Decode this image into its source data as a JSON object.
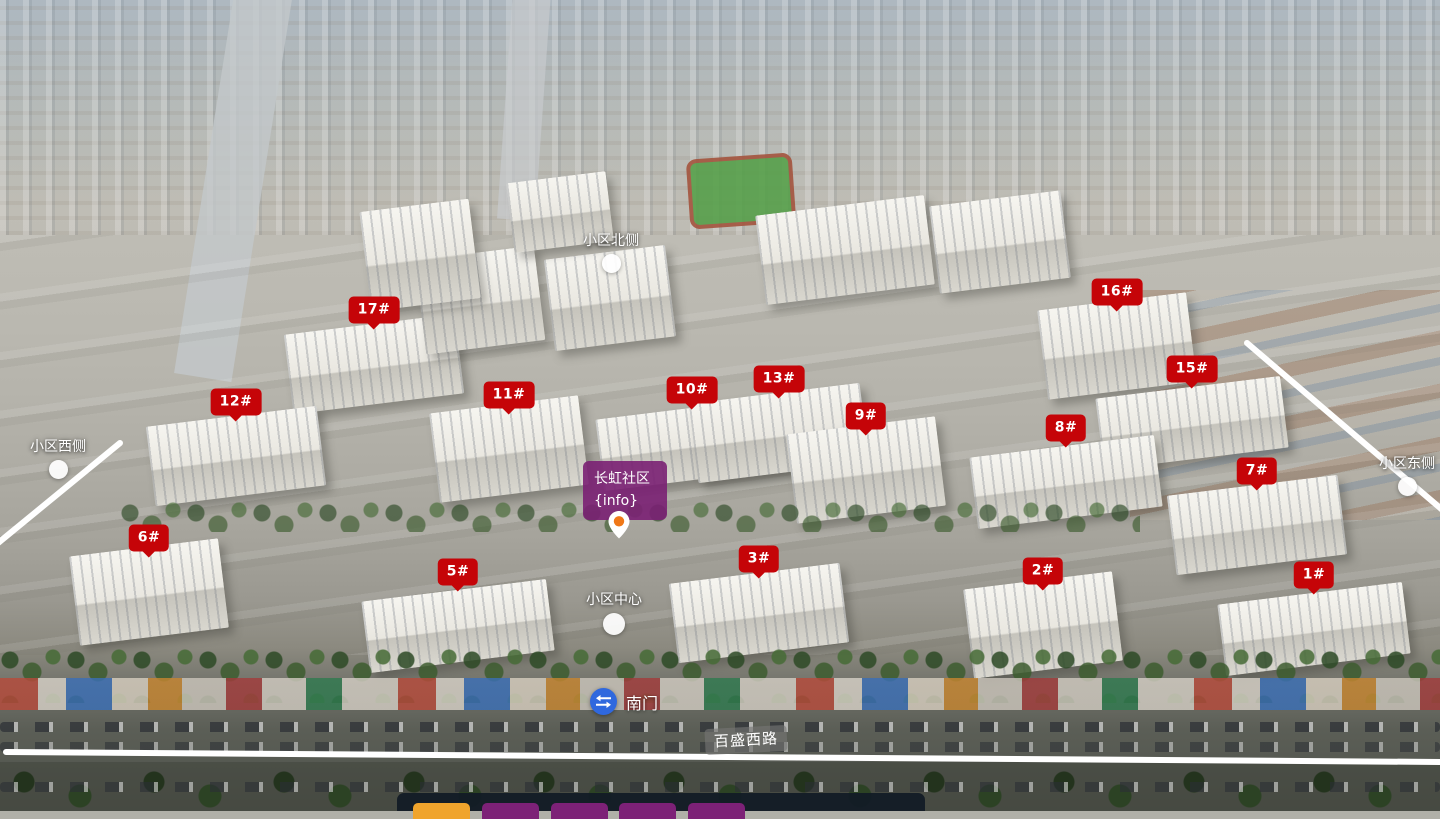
{
  "community": {
    "name_label": {
      "title": "长虹社区",
      "subtitle": "{info}",
      "x": 583,
      "y": 461
    }
  },
  "building_markers": [
    {
      "label": "17#",
      "x": 374,
      "y": 310
    },
    {
      "label": "16#",
      "x": 1117,
      "y": 292
    },
    {
      "label": "15#",
      "x": 1192,
      "y": 369
    },
    {
      "label": "12#",
      "x": 236,
      "y": 402
    },
    {
      "label": "11#",
      "x": 509,
      "y": 395
    },
    {
      "label": "10#",
      "x": 692,
      "y": 390
    },
    {
      "label": "13#",
      "x": 779,
      "y": 379
    },
    {
      "label": "9#",
      "x": 866,
      "y": 416
    },
    {
      "label": "8#",
      "x": 1066,
      "y": 428
    },
    {
      "label": "7#",
      "x": 1257,
      "y": 471
    },
    {
      "label": "6#",
      "x": 149,
      "y": 538
    },
    {
      "label": "5#",
      "x": 458,
      "y": 572
    },
    {
      "label": "3#",
      "x": 759,
      "y": 559
    },
    {
      "label": "2#",
      "x": 1043,
      "y": 571
    },
    {
      "label": "1#",
      "x": 1314,
      "y": 575
    }
  ],
  "nav_hotspots": [
    {
      "label": "小区北侧",
      "x": 611,
      "y": 230,
      "size": "normal"
    },
    {
      "label": "小区西侧",
      "x": 58,
      "y": 436,
      "size": "normal"
    },
    {
      "label": "小区东侧",
      "x": 1407,
      "y": 453,
      "size": "normal"
    },
    {
      "label": "小区中心",
      "x": 614,
      "y": 589,
      "size": "center"
    }
  ],
  "gate": {
    "label": "南门",
    "x": 590,
    "y": 688
  },
  "road_label": {
    "text": "百盛西路",
    "x": 705,
    "y": 727
  },
  "pin": {
    "x": 619,
    "y": 543
  },
  "thumbnails": [
    {
      "name": "scene-1",
      "state": "active",
      "color": "#f0a42c",
      "x": 413
    },
    {
      "name": "scene-2",
      "state": "inactive",
      "color": "#7d2177",
      "x": 482
    },
    {
      "name": "scene-3",
      "state": "inactive",
      "color": "#7d2177",
      "x": 551
    },
    {
      "name": "scene-4",
      "state": "inactive",
      "color": "#7d2177",
      "x": 619
    },
    {
      "name": "scene-5",
      "state": "inactive",
      "color": "#7d2177",
      "x": 688
    }
  ],
  "boundary_lines": {
    "color": "#ffffff",
    "left": {
      "x1": 120,
      "y1": 443,
      "x2": -8,
      "y2": 548
    },
    "right": {
      "x1": 1247,
      "y1": 343,
      "x2": 1446,
      "y2": 513
    },
    "bottom": {
      "x1": 6,
      "y1": 752,
      "x2": 1442,
      "y2": 762
    }
  },
  "colors": {
    "badge_red": "#c50408",
    "label_purple": "#7a2073",
    "gate_blue": "#2f68de",
    "pin_orange": "#f07818",
    "thumb_active": "#f0a42c",
    "thumb_inactive": "#7d2177"
  }
}
